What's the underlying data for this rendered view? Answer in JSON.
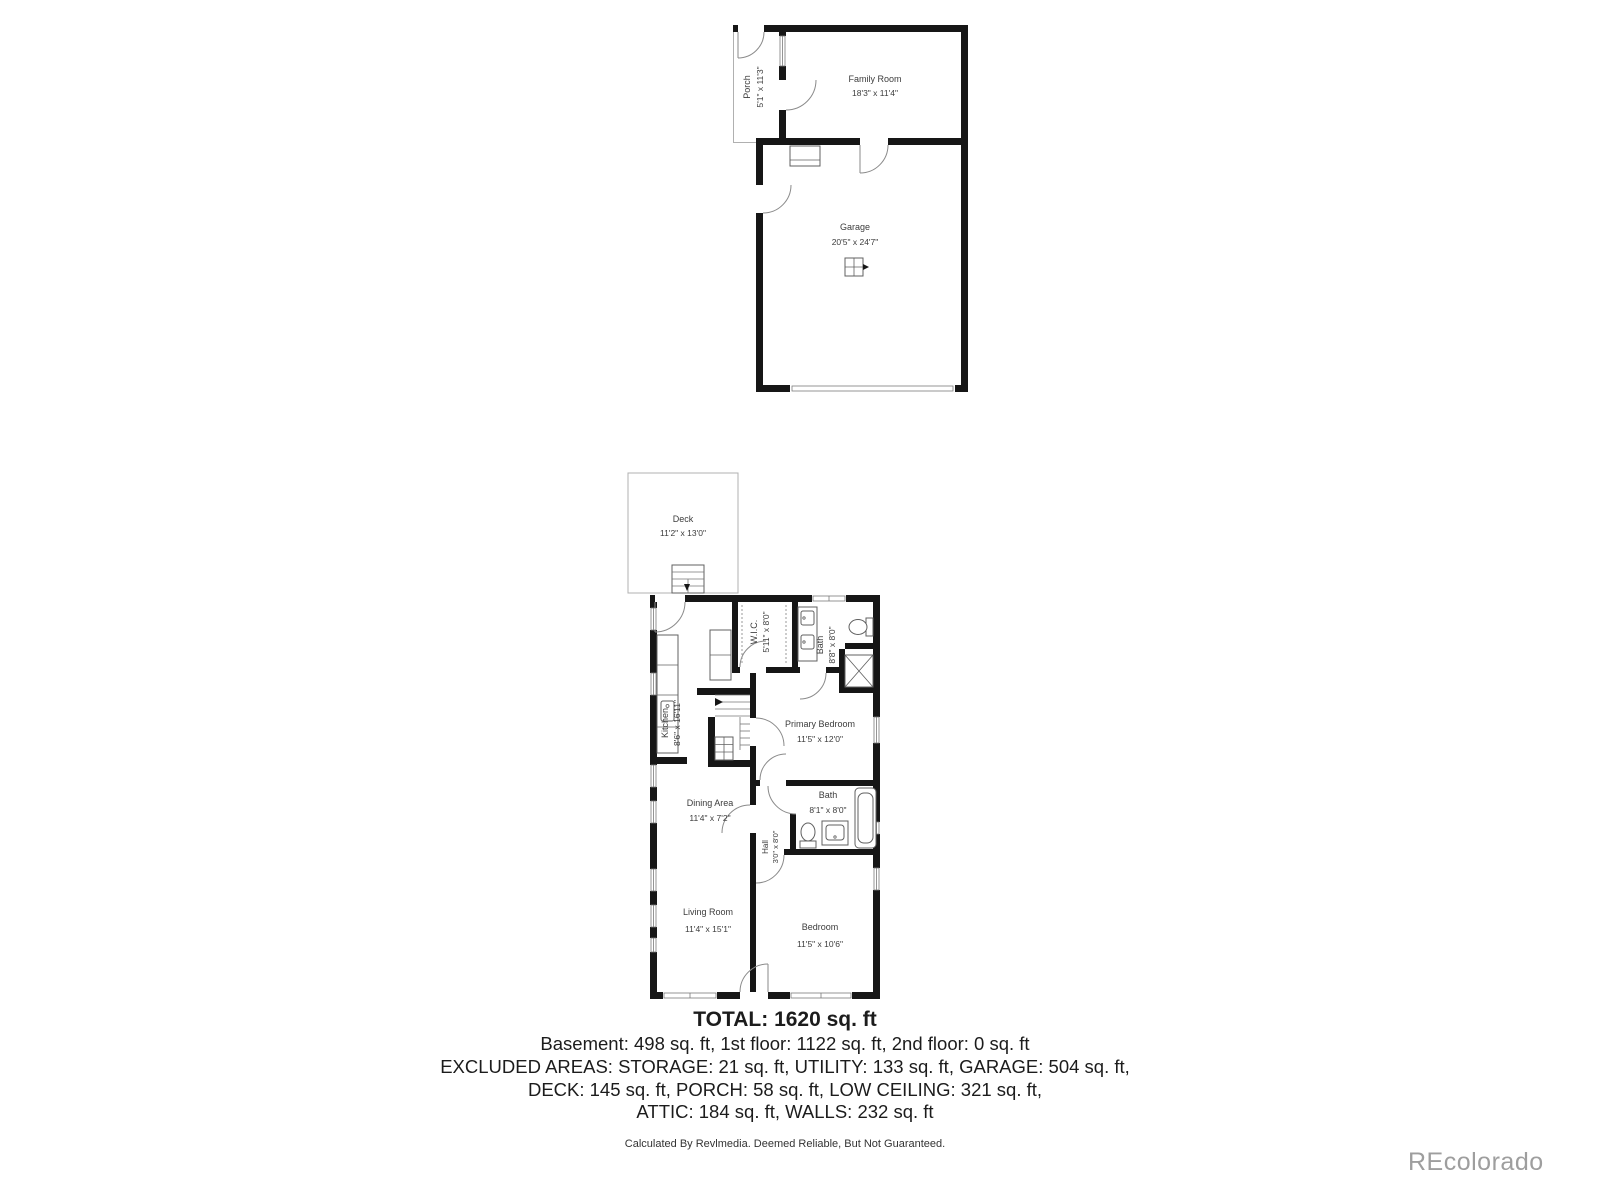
{
  "watermark": "REcolorado",
  "summary": {
    "total": "TOTAL: 1620 sq. ft",
    "line1": "Basement: 498 sq. ft, 1st floor: 1122 sq. ft, 2nd floor: 0 sq. ft",
    "line2": "EXCLUDED AREAS: STORAGE: 21 sq. ft, UTILITY: 133 sq. ft, GARAGE: 504 sq. ft,",
    "line3": "DECK: 145 sq. ft, PORCH: 58 sq. ft, LOW CEILING: 321 sq. ft,",
    "line4": "ATTIC: 184 sq. ft, WALLS: 232 sq. ft",
    "disclaimer": "Calculated By Revlmedia. Deemed Reliable, But Not Guaranteed."
  },
  "basement_plan": {
    "porch": {
      "name": "Porch",
      "dims": "5'1\" x 11'3\""
    },
    "family_room": {
      "name": "Family Room",
      "dims": "18'3\" x 11'4\""
    },
    "garage": {
      "name": "Garage",
      "dims": "20'5\" x 24'7\""
    }
  },
  "first_floor_plan": {
    "deck": {
      "name": "Deck",
      "dims": "11'2\" x 13'0\""
    },
    "kitchen": {
      "name": "Kitchen",
      "dims": "8'6\" x 16'11\""
    },
    "wic": {
      "name": "W.I.C.",
      "dims": "5'11\" x 8'0\""
    },
    "bath_upper": {
      "name": "Bath",
      "dims": "8'8\" x 8'0\""
    },
    "primary_bedroom": {
      "name": "Primary Bedroom",
      "dims": "11'5\" x 12'0\""
    },
    "dining_area": {
      "name": "Dining Area",
      "dims": "11'4\" x 7'2\""
    },
    "hall": {
      "name": "Hall",
      "dims": "3'0\" x 8'0\""
    },
    "bath_lower": {
      "name": "Bath",
      "dims": "8'1\" x 8'0\""
    },
    "living_room": {
      "name": "Living Room",
      "dims": "11'4\" x 15'1\""
    },
    "bedroom": {
      "name": "Bedroom",
      "dims": "11'5\" x 10'6\""
    }
  }
}
